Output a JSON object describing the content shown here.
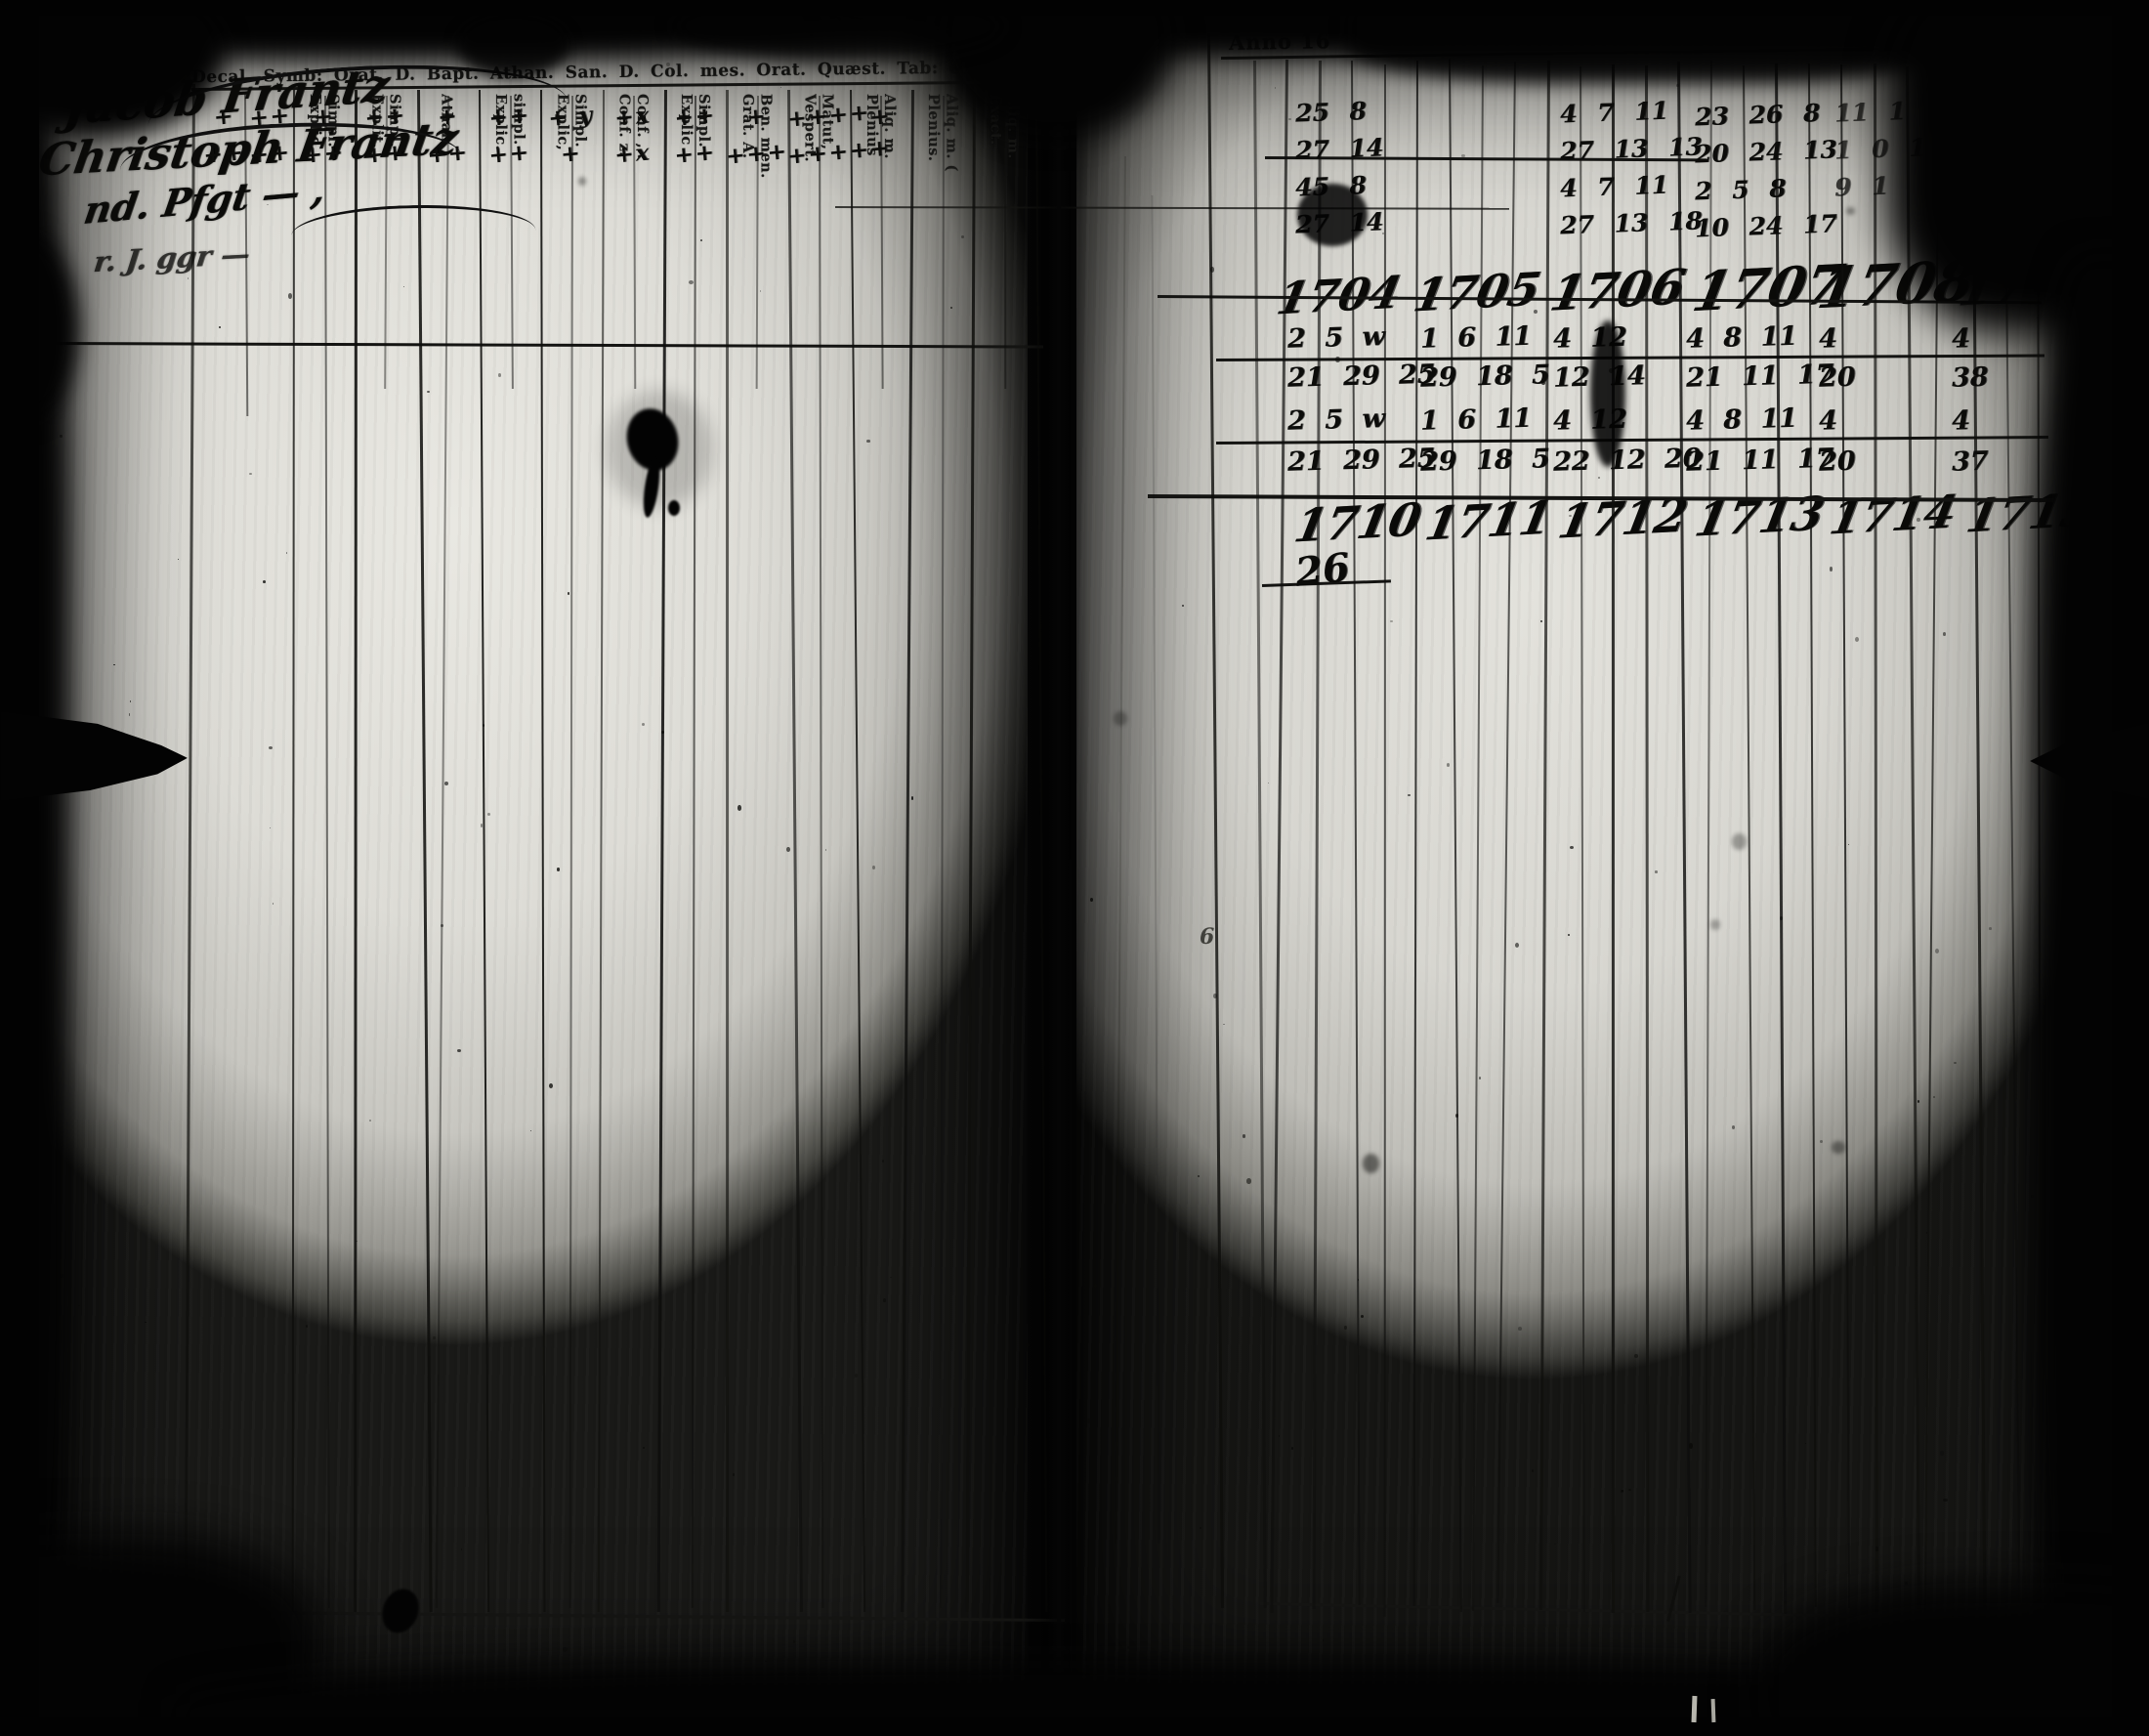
{
  "left_page": {
    "header_row": "Decal. Symb: Orat. D. Bapt. Athan. San. D. Col. mes. Orat. Quæst. Tab: et cat. L. v.",
    "columns": [
      {
        "l1": "Explic.",
        "l2": "Simpl."
      },
      {
        "l1": "Explit.",
        "l2": "Simpl."
      },
      {
        "l1": "Athan.",
        "l2": ""
      },
      {
        "l1": "Explic.",
        "l2": "simpl."
      },
      {
        "l1": "Explic,",
        "l2": "Simpl."
      },
      {
        "l1": "Conf. z.",
        "l2": "Conf. ,.."
      },
      {
        "l1": "Explic",
        "l2": "Simpl."
      },
      {
        "l1": "Grat. A.",
        "l2": "Ben. men."
      },
      {
        "l1": "Vespert.",
        "l2": "Matut,"
      },
      {
        "l1": "Plenius",
        "l2": "Aliq. m."
      },
      {
        "l1": "Plenius.",
        "l2": "Aliq. m. ("
      },
      {
        "l1": "Exact.",
        "l2": "Aliq. m."
      }
    ],
    "entry1_name": "Jacob Frantz",
    "entry1_marks": [
      "+",
      "++",
      "+",
      "++",
      "+",
      "++",
      "+ y",
      "+x",
      "++",
      "+",
      "++++",
      "+",
      "",
      ""
    ],
    "entry2_name": "Christoph Frantz",
    "entry2_marks": [
      "++",
      "++",
      "++",
      "++",
      "++",
      "++",
      "+",
      "+x",
      "++",
      "+++",
      "+++++",
      "",
      "",
      ""
    ],
    "entry3_scribble": "nd. Pfgt — ,",
    "entry4_scribble": "r. J. ggr —"
  },
  "right_page": {
    "anno_label": "Anno 16",
    "printed_year_fragments": [
      "17",
      "17",
      "17",
      "17"
    ],
    "top_group1_rows": [
      "25 8",
      "27 14",
      "45 8",
      "27 14"
    ],
    "top_group2_rows": [
      "4 7 11",
      "27 13 13",
      "4 7 11",
      "27 13 18"
    ],
    "top_group3_rows": [
      "23 26 8",
      "20 24 13",
      "2 5 8",
      "10 24 17"
    ],
    "top_group4_rows": [
      "11 1",
      "1 0 1",
      "9 1",
      ""
    ],
    "years_row1": [
      "1704",
      "1705",
      "1706",
      "1707",
      "1708"
    ],
    "years_row1_tail": "17",
    "mid_row1": [
      "2 5 w",
      "1 6 11",
      "4  12",
      "4 8 11",
      "4",
      "4"
    ],
    "mid_row2": [
      "21 29 25",
      "29 18 5",
      "12  14",
      "21 11 17",
      "20",
      "38"
    ],
    "mid_row3": [
      "2 5 w",
      "1 6 11",
      "4  12",
      "4 8 11",
      "4",
      "4"
    ],
    "mid_row4": [
      "21 29 25",
      "29 18 5",
      "22 12 20",
      "21 11 17",
      "20",
      "37"
    ],
    "years_row2": [
      "1710",
      "1711",
      "1712",
      "1713",
      "1714",
      "1715"
    ],
    "crossed_number": "26",
    "margin_mark": "6"
  }
}
